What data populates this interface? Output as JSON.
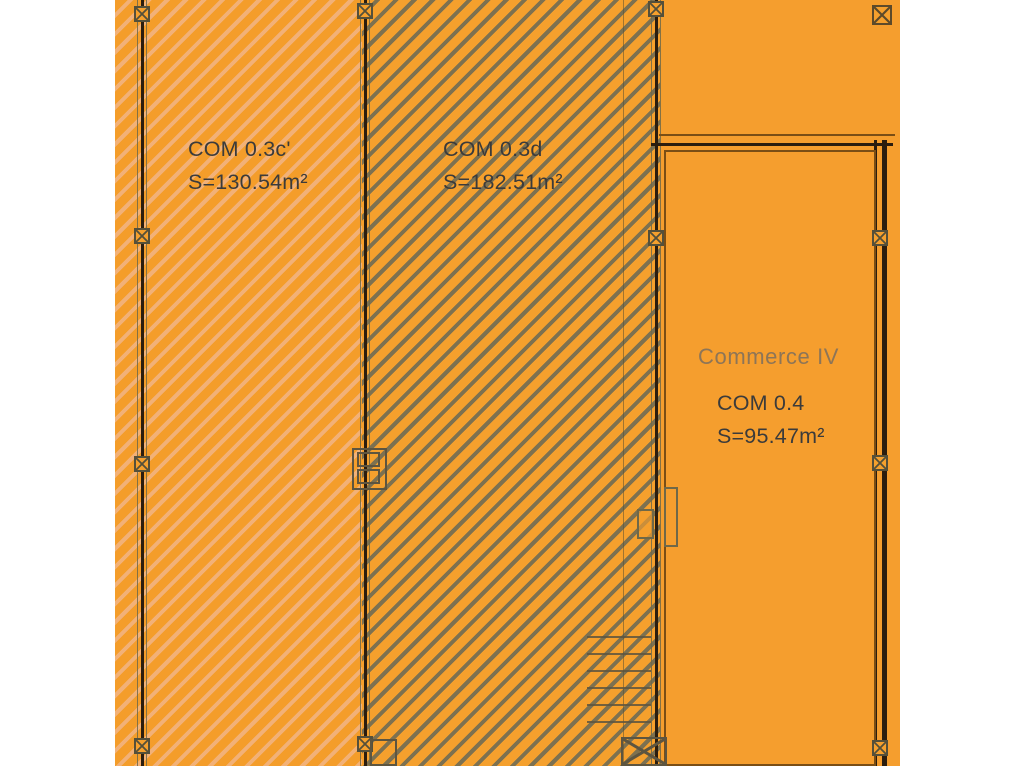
{
  "plan": {
    "zones": [
      {
        "label": "COM 0.3c'",
        "area": "S=130.54m²",
        "hatch": "light-orange-diagonal"
      },
      {
        "label": "COM 0.3d",
        "area": "S=182.51m²",
        "hatch": "dark-diagonal"
      },
      {
        "title": "Commerce IV",
        "label": "COM 0.4",
        "area": "S=95.47m²",
        "hatch": "none"
      }
    ]
  },
  "colors": {
    "page_background": "#FFFFFF",
    "plan_orange": "#F59E2E",
    "hatch_light": "#F2B177",
    "hatch_dark": "#7D7150",
    "wall_core": "#2B1D0E",
    "detail_line": "#6F6848",
    "inner_outline": "#7A4E15",
    "label_text": "#3B3B3B",
    "commerce_title_text": "#8D7557"
  },
  "icons": {
    "junction_marker": "crossed square ⊠",
    "door_marker": "door frame rectangles",
    "stairs_marker": "ladder rungs",
    "hatch_access": "crossed rectangle"
  }
}
